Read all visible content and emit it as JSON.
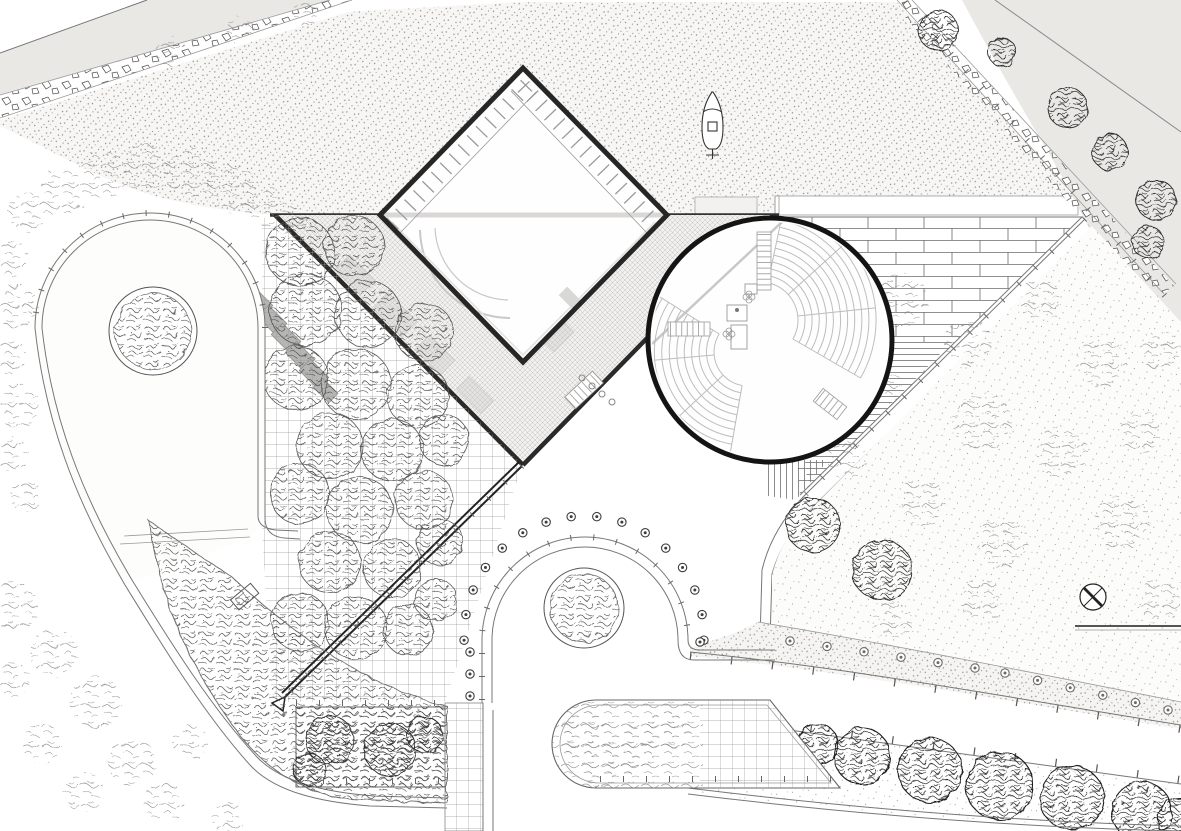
{
  "drawing": {
    "kind": "architectural-site-plan",
    "features": {
      "building": "diamond-pavilion",
      "theater": "circular-amphitheater",
      "plaza": "crosshatched-canopy-plaza",
      "grove": "gridded-tree-grove",
      "loop": "teardrop-lawn-loop",
      "waterfront": "stippled-water-basin-with-boat"
    }
  },
  "palette": {
    "ink": "#1a1a1a",
    "building_line": "#262626",
    "water_base": "#f7f6f4",
    "road_gray": "#e9e8e5",
    "plan_gray": "#c9c8c6",
    "grid_line": "#9a9a9a",
    "veg_dark": "#2b2b2b",
    "veg_med": "#555555",
    "veg_light": "#8a8a8a",
    "curb": "#555555"
  },
  "icons": {
    "boat": "boat-icon",
    "crossed_circle": "crossed-circle-marker-icon"
  },
  "amphitheater": {
    "cx": 770,
    "cy": 340,
    "r": 122,
    "fans": [
      {
        "cx": 760,
        "cy": 320,
        "r0": 38,
        "r1": 116,
        "rows": 12,
        "a0": -78,
        "a1": 30,
        "aisles": [
          -78,
          -42,
          -6,
          30
        ]
      },
      {
        "cx": 748,
        "cy": 352,
        "r0": 34,
        "r1": 116,
        "rows": 12,
        "a0": 100,
        "a1": 212,
        "aisles": [
          100,
          137,
          175,
          212
        ]
      }
    ]
  },
  "vegetation": [
    {
      "layer": "grove-trees",
      "style": "med",
      "item_name": "grove-tree-canopy",
      "items": [
        [
          300,
          252,
          34
        ],
        [
          354,
          246,
          30
        ],
        [
          306,
          310,
          36
        ],
        [
          368,
          314,
          33
        ],
        [
          424,
          332,
          29
        ],
        [
          296,
          378,
          32
        ],
        [
          356,
          384,
          35
        ],
        [
          418,
          396,
          31
        ],
        [
          330,
          446,
          33
        ],
        [
          392,
          450,
          31
        ],
        [
          444,
          440,
          25
        ],
        [
          300,
          494,
          30
        ],
        [
          360,
          510,
          33
        ],
        [
          424,
          500,
          29
        ],
        [
          330,
          562,
          31
        ],
        [
          392,
          568,
          29
        ],
        [
          440,
          542,
          23
        ],
        [
          300,
          622,
          29
        ],
        [
          356,
          628,
          31
        ],
        [
          408,
          630,
          25
        ],
        [
          436,
          600,
          21
        ]
      ]
    },
    {
      "layer": "fringe-top-trees",
      "style": "light",
      "item_name": "shore-shrub",
      "items": [
        [
          28,
          212,
          20
        ],
        [
          62,
          192,
          24
        ],
        [
          102,
          176,
          26
        ],
        [
          146,
          168,
          24
        ],
        [
          190,
          172,
          26
        ],
        [
          232,
          188,
          24
        ],
        [
          266,
          206,
          20
        ],
        [
          290,
          222,
          16
        ],
        [
          170,
          52,
          16
        ],
        [
          240,
          30,
          14
        ],
        [
          305,
          14,
          12
        ]
      ]
    },
    {
      "layer": "fringe-left-trees",
      "style": "light",
      "item_name": "edge-shrub",
      "items": [
        [
          8,
          258,
          20
        ],
        [
          16,
          306,
          22
        ],
        [
          6,
          356,
          20
        ],
        [
          18,
          406,
          22
        ],
        [
          10,
          454,
          18
        ],
        [
          26,
          496,
          16
        ]
      ]
    },
    {
      "layer": "fringe-sw-trees",
      "style": "light",
      "item_name": "path-shrub",
      "items": [
        [
          14,
          606,
          24
        ],
        [
          54,
          652,
          24
        ],
        [
          96,
          702,
          26
        ],
        [
          42,
          744,
          20
        ],
        [
          132,
          762,
          24
        ],
        [
          84,
          792,
          20
        ],
        [
          12,
          680,
          18
        ],
        [
          164,
          802,
          20
        ],
        [
          228,
          818,
          16
        ],
        [
          190,
          742,
          18
        ]
      ]
    },
    {
      "layer": "meadow-light-trees",
      "style": "light",
      "item_name": "meadow-shrub",
      "items": [
        [
          900,
          300,
          28
        ],
        [
          968,
          342,
          24
        ],
        [
          1040,
          302,
          22
        ],
        [
          1102,
          362,
          26
        ],
        [
          982,
          422,
          30
        ],
        [
          880,
          382,
          22
        ],
        [
          1062,
          452,
          26
        ],
        [
          1140,
          432,
          22
        ],
        [
          922,
          502,
          24
        ],
        [
          1002,
          542,
          26
        ],
        [
          1122,
          522,
          28
        ],
        [
          1158,
          602,
          22
        ],
        [
          982,
          602,
          22
        ],
        [
          892,
          622,
          20
        ],
        [
          848,
          460,
          20
        ],
        [
          1160,
          350,
          20
        ]
      ]
    },
    {
      "layer": "meadow-dark-trees",
      "style": "dark",
      "item_name": "meadow-tree",
      "items": [
        [
          813,
          525,
          27
        ],
        [
          882,
          570,
          30
        ]
      ]
    },
    {
      "layer": "ne-roadside-trees",
      "style": "dark",
      "item_name": "roadside-tree",
      "items": [
        [
          938,
          30,
          20
        ],
        [
          1002,
          52,
          14
        ],
        [
          1068,
          108,
          20
        ],
        [
          1110,
          152,
          18
        ],
        [
          1156,
          200,
          20
        ],
        [
          1148,
          242,
          16
        ]
      ]
    },
    {
      "layer": "tree-row-trees",
      "style": "spiky",
      "item_name": "street-tree",
      "items": [
        [
          818,
          744,
          20
        ],
        [
          862,
          756,
          28
        ],
        [
          930,
          770,
          32
        ],
        [
          1000,
          786,
          34
        ],
        [
          1072,
          798,
          32
        ],
        [
          1142,
          812,
          30
        ],
        [
          1180,
          820,
          22
        ]
      ]
    },
    {
      "layer": "bed-shrubs",
      "style": "dark",
      "item_name": "bed-shrub",
      "items": [
        [
          330,
          740,
          24
        ],
        [
          390,
          750,
          26
        ],
        [
          425,
          735,
          18
        ],
        [
          310,
          770,
          16
        ]
      ]
    },
    {
      "layer": "stadium-shrubs",
      "style": "light",
      "item_name": "stadium-shrub",
      "items": [
        [
          585,
          735,
          26
        ],
        [
          630,
          750,
          24
        ],
        [
          668,
          730,
          22
        ],
        [
          600,
          770,
          18
        ]
      ]
    }
  ],
  "planters": [
    {
      "name": "loop-planter",
      "cx": 153,
      "cy": 331,
      "r_outer": 44,
      "r_inner": 38
    },
    {
      "name": "arch-planter",
      "cx": 584,
      "cy": 608,
      "r_outer": 40,
      "r_inner": 34
    }
  ],
  "bollards": {
    "groups": [
      {
        "layer": "arch-bollards",
        "color": "#3d3d3d",
        "specs": [
          {
            "arc": [
              584,
              636,
              120,
              178,
              362,
              16
            ]
          },
          {
            "line": [
              470,
              652,
              470,
              696,
              3
            ]
          },
          {
            "line": [
              700,
              642,
              700,
              646,
              1
            ]
          }
        ]
      },
      {
        "layer": "band-lights",
        "color": "#6a6a6a",
        "specs": [
          {
            "line": [
              790,
              641,
              975,
              668,
              6
            ]
          },
          {
            "line": [
              1005,
              673,
              1168,
              710,
              6
            ]
          }
        ]
      }
    ]
  }
}
